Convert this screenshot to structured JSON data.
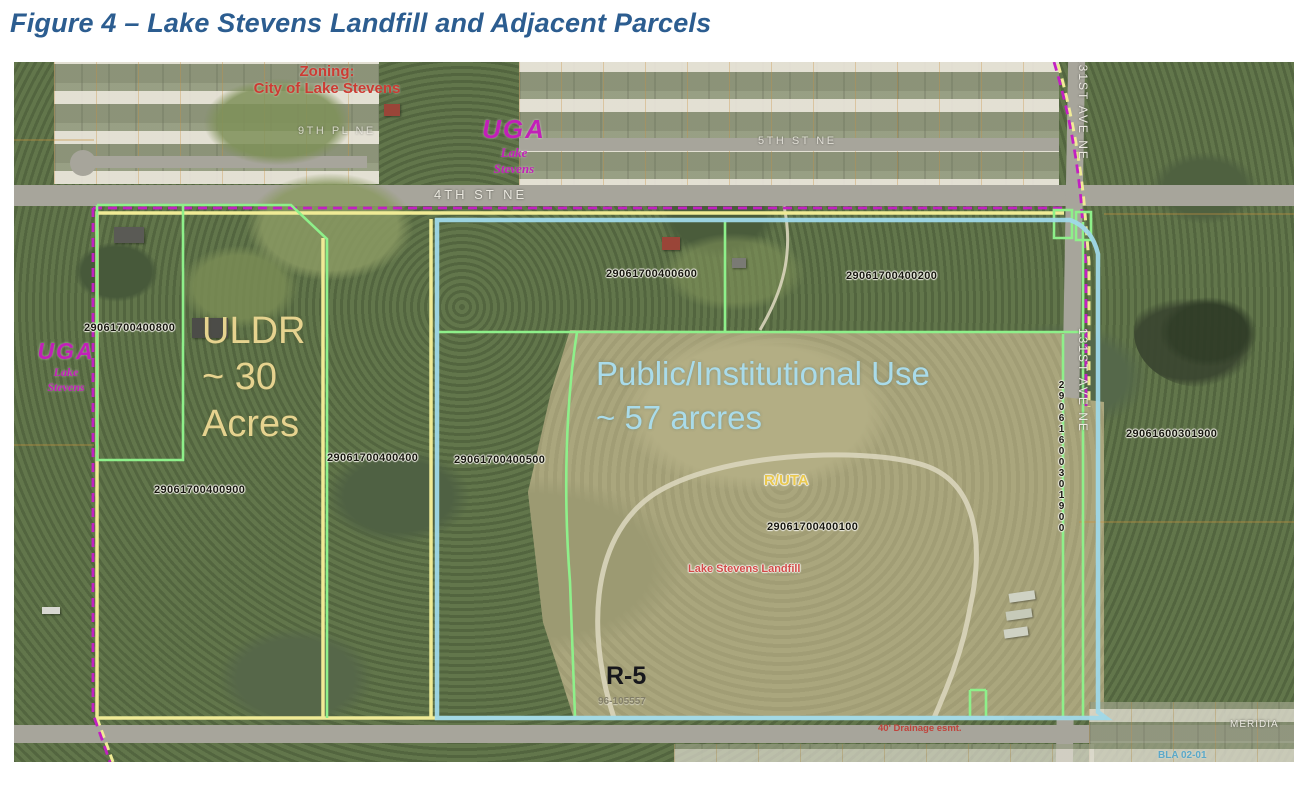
{
  "title": "Figure 4 – Lake Stevens Landfill and Adjacent Parcels",
  "map": {
    "zoning": {
      "line1": "Zoning:",
      "line2": "City of Lake Stevens"
    },
    "uga_top": {
      "name": "UGA",
      "city_line1": "Lake",
      "city_line2": "Stevens"
    },
    "uga_left": {
      "name": "UGA",
      "city_line1": "Lake",
      "city_line2": "Stevens"
    },
    "streets": {
      "fourth_st": "4TH ST NE",
      "fifth_st": "5TH ST NE",
      "ninth_pl": "9TH PL NE",
      "ave_131_upper": "131ST AVE NE",
      "ave_131_lower": "131ST AVE NE",
      "meridian": "MERIDIA"
    },
    "parcels": {
      "p400800": "29061700400800",
      "p400600": "29061700400600",
      "p400200": "29061700400200",
      "p400400": "29061700400400",
      "p400500": "29061700400500",
      "p400900": "29061700400900",
      "p400100": "29061700400100",
      "p301900_h": "29061600301900",
      "p301900_v": "29061600301900"
    },
    "annotations": {
      "uldr_line1": "ULDR",
      "uldr_line2": "~ 30",
      "uldr_line3": "Acres",
      "public_line1": "Public/Institutional Use",
      "public_line2": "~ 57 arcres",
      "ruta": "R/UTA",
      "landfill": "Lake Stevens Landfill",
      "zone_r5": "R-5",
      "permit": "96-105557",
      "drainage": "40' Drainage esmt.",
      "bla": "BLA 02-01"
    },
    "legend_colors": {
      "uga_boundary_magenta": "#c220c2",
      "parcel_outline_yellow": "#f0eb96",
      "parcel_outline_green": "#8ef08a",
      "site_boundary_cyan": "#9fd8e8"
    }
  }
}
